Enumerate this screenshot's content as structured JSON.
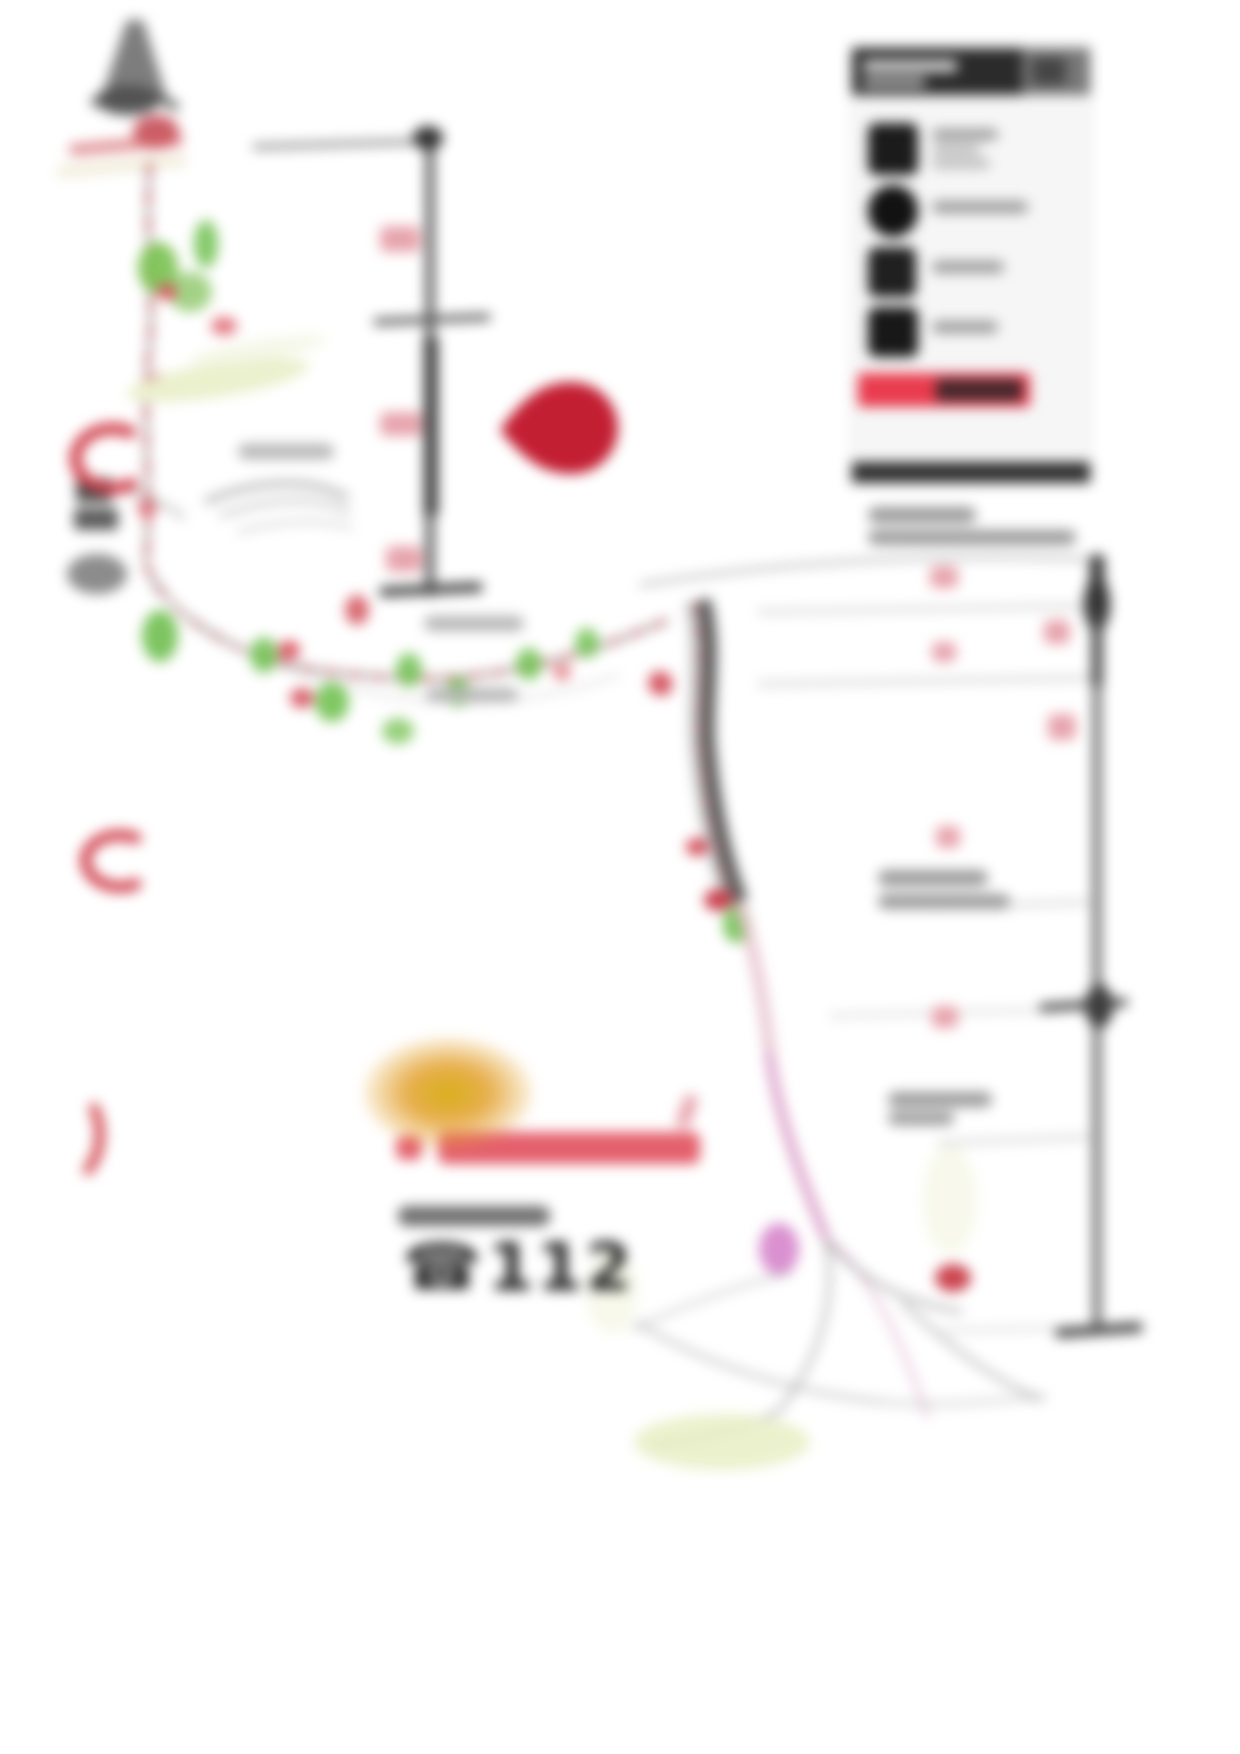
{
  "emergency": {
    "phone_icon": "☎",
    "number": "112"
  },
  "colors": {
    "pin_red": "#c31f33",
    "legend_red": "#ee4254",
    "legend_black": "#2b2b2b",
    "watermark_red": "#e4606c",
    "route_red_dashed": "#c05058",
    "route_green": "#6fbf4f",
    "ledge_pale_green": "#ebf0cd",
    "variant_magenta": "#d685cb",
    "orange_highlight": "#e2a320",
    "terrain_gray": "#8a8a8a"
  }
}
